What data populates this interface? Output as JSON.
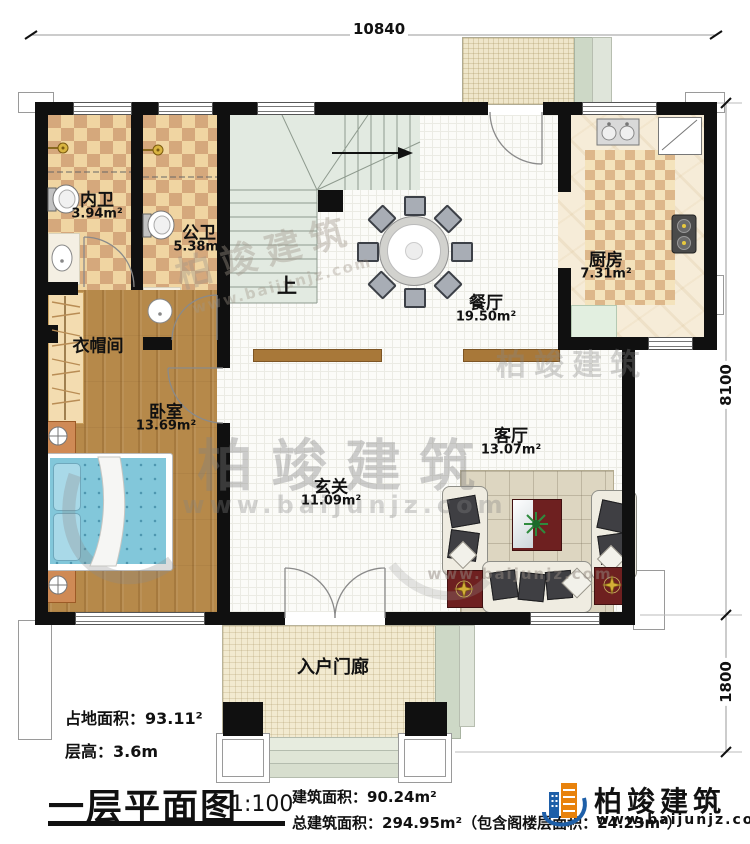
{
  "dimensions": {
    "top": "10840",
    "right_upper": "8100",
    "right_lower": "1800"
  },
  "rooms": {
    "neiwei": {
      "name": "内卫",
      "area": "3.94m²"
    },
    "gongwei": {
      "name": "公卫",
      "area": "5.38m²"
    },
    "chufang": {
      "name": "厨房",
      "area": "7.31m²"
    },
    "canting": {
      "name": "餐厅",
      "area": "19.50m²"
    },
    "yimaojian": {
      "name": "衣帽间"
    },
    "woshi": {
      "name": "卧室",
      "area": "13.69m²"
    },
    "keting": {
      "name": "客厅",
      "area": "13.07m²"
    },
    "xuanguan": {
      "name": "玄关",
      "area": "11.09m²"
    },
    "menlang": {
      "name": "入户门廊"
    }
  },
  "stairs": {
    "direction_label": "上"
  },
  "footer": {
    "land_area": "占地面积：93.11²",
    "floor_height": "层高：3.6m",
    "plan_title": "一层平面图",
    "scale": "1:100",
    "floor_area": "建筑面积：90.24m²",
    "total_area": "总建筑面积：294.95m²（包含阁楼层面积：24.23m²）"
  },
  "brand": {
    "name": "柏竣建筑",
    "website": "www.baijunjz.com"
  },
  "watermark": {
    "name": "柏竣建筑",
    "website": "www.baijunjz.com"
  },
  "colors": {
    "wall": "#101010",
    "accent_blue": "#1e5fa8",
    "accent_orange": "#e8820c"
  }
}
